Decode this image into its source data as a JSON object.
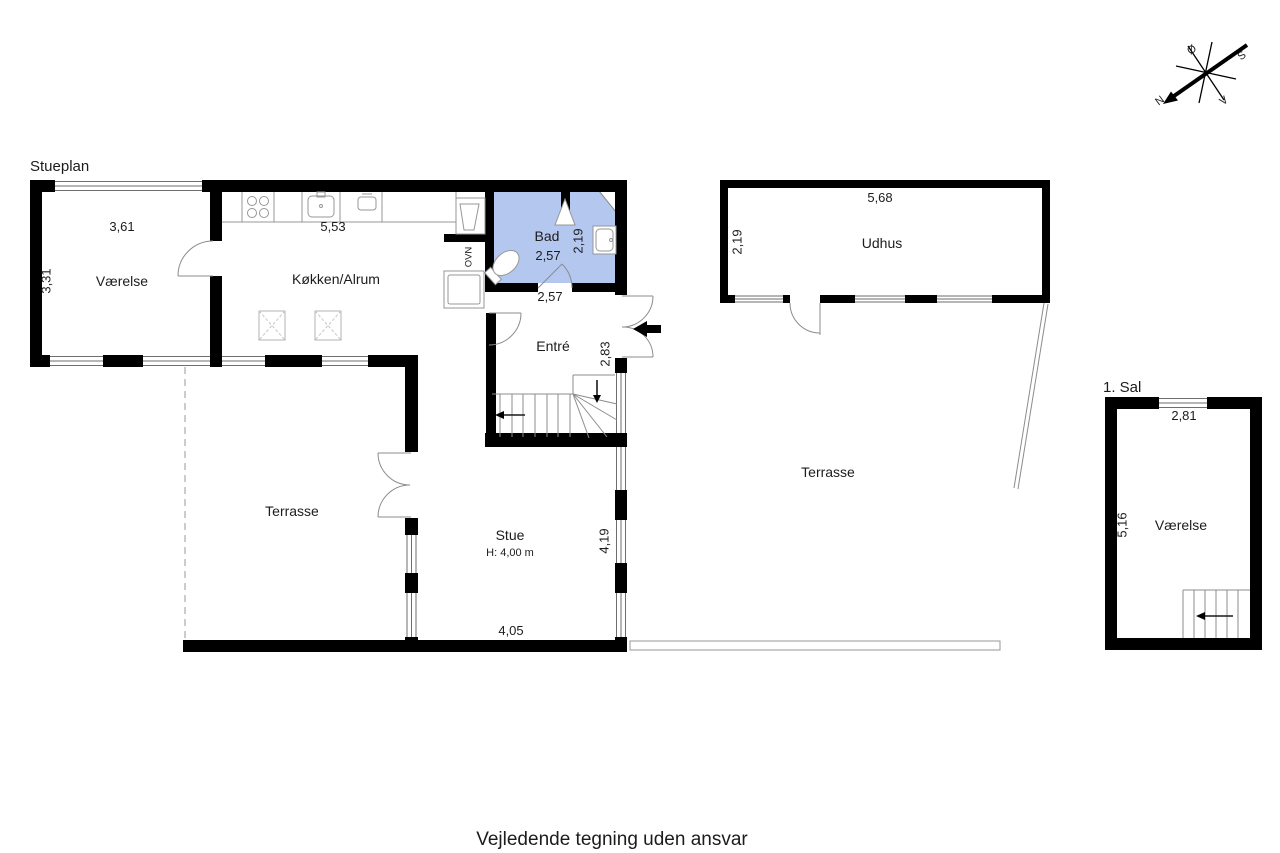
{
  "header": {
    "ground_floor": "Stueplan",
    "first_floor": "1. Sal"
  },
  "note": {
    "disclaimer": "Vejledende tegning uden ansvar"
  },
  "compass": {
    "n": "N",
    "s": "S",
    "e": "Ø",
    "w": "V"
  },
  "rooms": {
    "vaerelse": {
      "label": "Værelse",
      "width": "3,61",
      "depth": "3,31"
    },
    "koekken": {
      "label": "Køkken/Alrum",
      "width": "5,53"
    },
    "bad": {
      "label": "Bad",
      "width": "2,57",
      "depth": "2,19"
    },
    "entre": {
      "label": "Entré",
      "width": "2,57",
      "depth": "2,83"
    },
    "stue": {
      "label": "Stue",
      "ceiling_height": "H: 4,00 m",
      "width": "4,05",
      "depth": "4,19"
    },
    "terrasse_left": {
      "label": "Terrasse"
    },
    "terrasse_right": {
      "label": "Terrasse"
    },
    "udhus": {
      "label": "Udhus",
      "width": "5,68",
      "depth": "2,19"
    },
    "sal_vaerelse": {
      "label": "Værelse",
      "width": "2,81",
      "depth": "5,16"
    }
  },
  "appliances": {
    "oven_label": "OVN"
  },
  "colors": {
    "bathroom_fill": "#b3c7ef",
    "wall": "#000000"
  }
}
